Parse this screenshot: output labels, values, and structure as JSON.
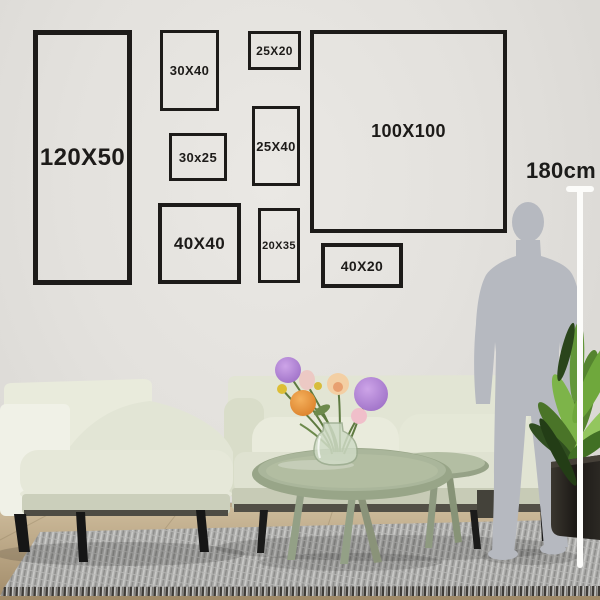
{
  "frames": [
    {
      "name": "frame-120x50",
      "label": "120X50"
    },
    {
      "name": "frame-30x40",
      "label": "30X40"
    },
    {
      "name": "frame-25x20",
      "label": "25X20"
    },
    {
      "name": "frame-30x25",
      "label": "30x25"
    },
    {
      "name": "frame-25x40",
      "label": "25X40"
    },
    {
      "name": "frame-40x40",
      "label": "40X40"
    },
    {
      "name": "frame-20x35",
      "label": "20X35"
    },
    {
      "name": "frame-100x100",
      "label": "100X100"
    },
    {
      "name": "frame-40x20",
      "label": "40X20"
    }
  ],
  "measurement": {
    "label": "180cm"
  },
  "colors": {
    "frame_outline": "#1d1b19",
    "label_text": "#1d1b19",
    "wall": "#e3e1dd",
    "sofa": "#e2e5d4",
    "armchair": "#e9ebdc",
    "table": "#aab69b",
    "rug": "#a9a9a7",
    "silhouette": "#b6b9c0",
    "measuring_line": "#fcfcfa",
    "floor": "#bda887",
    "plant_pot": "#23201c",
    "plant_leaf": "#6fa83c",
    "flower_purple": "#a97fd2",
    "flower_orange": "#e6913c",
    "flower_pink": "#eeb9c7",
    "flower_yellow": "#ddbe35",
    "vase_glass": "#cfdbc6"
  }
}
